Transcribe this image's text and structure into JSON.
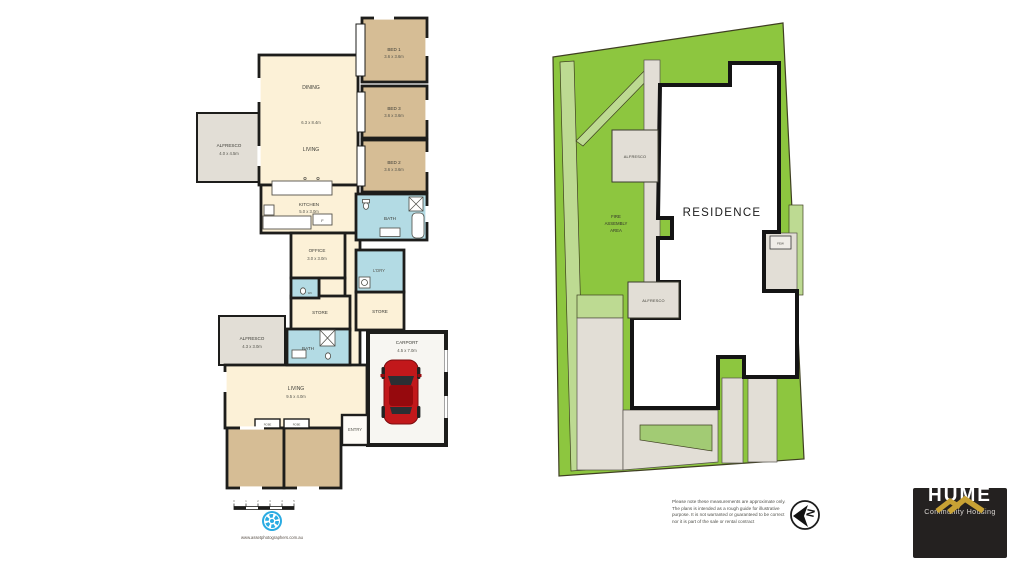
{
  "floor_plan": {
    "rooms": {
      "bed1": {
        "name": "BED 1",
        "dims": "3.6 x 3.6m"
      },
      "bed2": {
        "name": "BED 2",
        "dims": "3.6 x 3.6m"
      },
      "bed3": {
        "name": "BED 3",
        "dims": "3.6 x 3.6m"
      },
      "bed4": {
        "name": "BED 4",
        "dims": "3.6 x 3.6m"
      },
      "bed5": {
        "name": "BED 5",
        "dims": "3.6 x 3.6m"
      },
      "dining": {
        "name": "DINING"
      },
      "great_room": {
        "dims": "6.3 x 8.4m"
      },
      "living_upper": {
        "name": "LIVING"
      },
      "alfresco_left": {
        "name": "ALFRESCO",
        "dims": "4.0 x 4.5m"
      },
      "kitchen": {
        "name": "KITCHEN",
        "dims": "5.0 x 3.0m"
      },
      "office": {
        "name": "OFFICE",
        "dims": "3.0 x 3.0m"
      },
      "bath_top": {
        "name": "BATH"
      },
      "laundry": {
        "name": "L'DRY"
      },
      "wc": {
        "name": "WC"
      },
      "store_left": {
        "name": "STORE"
      },
      "store_right": {
        "name": "STORE"
      },
      "alfresco_lower": {
        "name": "ALFRESCO",
        "dims": "4.3 x 3.0m"
      },
      "bath_lower": {
        "name": "BATH"
      },
      "living_lower": {
        "name": "LIVING",
        "dims": "9.5 x 4.0m"
      },
      "carport": {
        "name": "CARPORT",
        "dims": "4.5 x 7.0m"
      },
      "entry": {
        "name": "ENTRY"
      },
      "robe": "ROBE",
      "fridge": "F"
    },
    "scale_ticks": [
      "0",
      "1",
      "2",
      "3",
      "4",
      "5"
    ],
    "credit_url": "www.assetphotographers.com.au"
  },
  "site_plan": {
    "residence": "RESIDENCE",
    "alfresco_upper": "ALFRESCO",
    "alfresco_lower": "ALFRESCO",
    "fire_assembly": {
      "line1": "FIRE",
      "line2": "ASSEMBLY",
      "line3": "AREA"
    },
    "few": "FEW",
    "compass_letter": "N"
  },
  "footer": {
    "disclaimer": "Please note these measurements are approximate only. The plans is intended as a rough guide for illustrative purpose. It is not warranted or guaranteed to be correct nor it is part of the sale or rental contract"
  },
  "brand": {
    "name": "HUME",
    "tagline": "Community Housing"
  },
  "colors": {
    "site_green": "#8dc63f",
    "site_light_green": "#bdda92",
    "floor_cream": "#fcf1d7",
    "bedroom_tan": "#d6bd95",
    "wet_area_blue": "#b3dbe4",
    "alfresco_gray": "#e2ded6",
    "wall_black": "#1d1d1b",
    "brand_gold": "#c8a234",
    "brand_bg": "#242120",
    "car_red": "#c2181b",
    "aperture_blue": "#2aabe2"
  }
}
